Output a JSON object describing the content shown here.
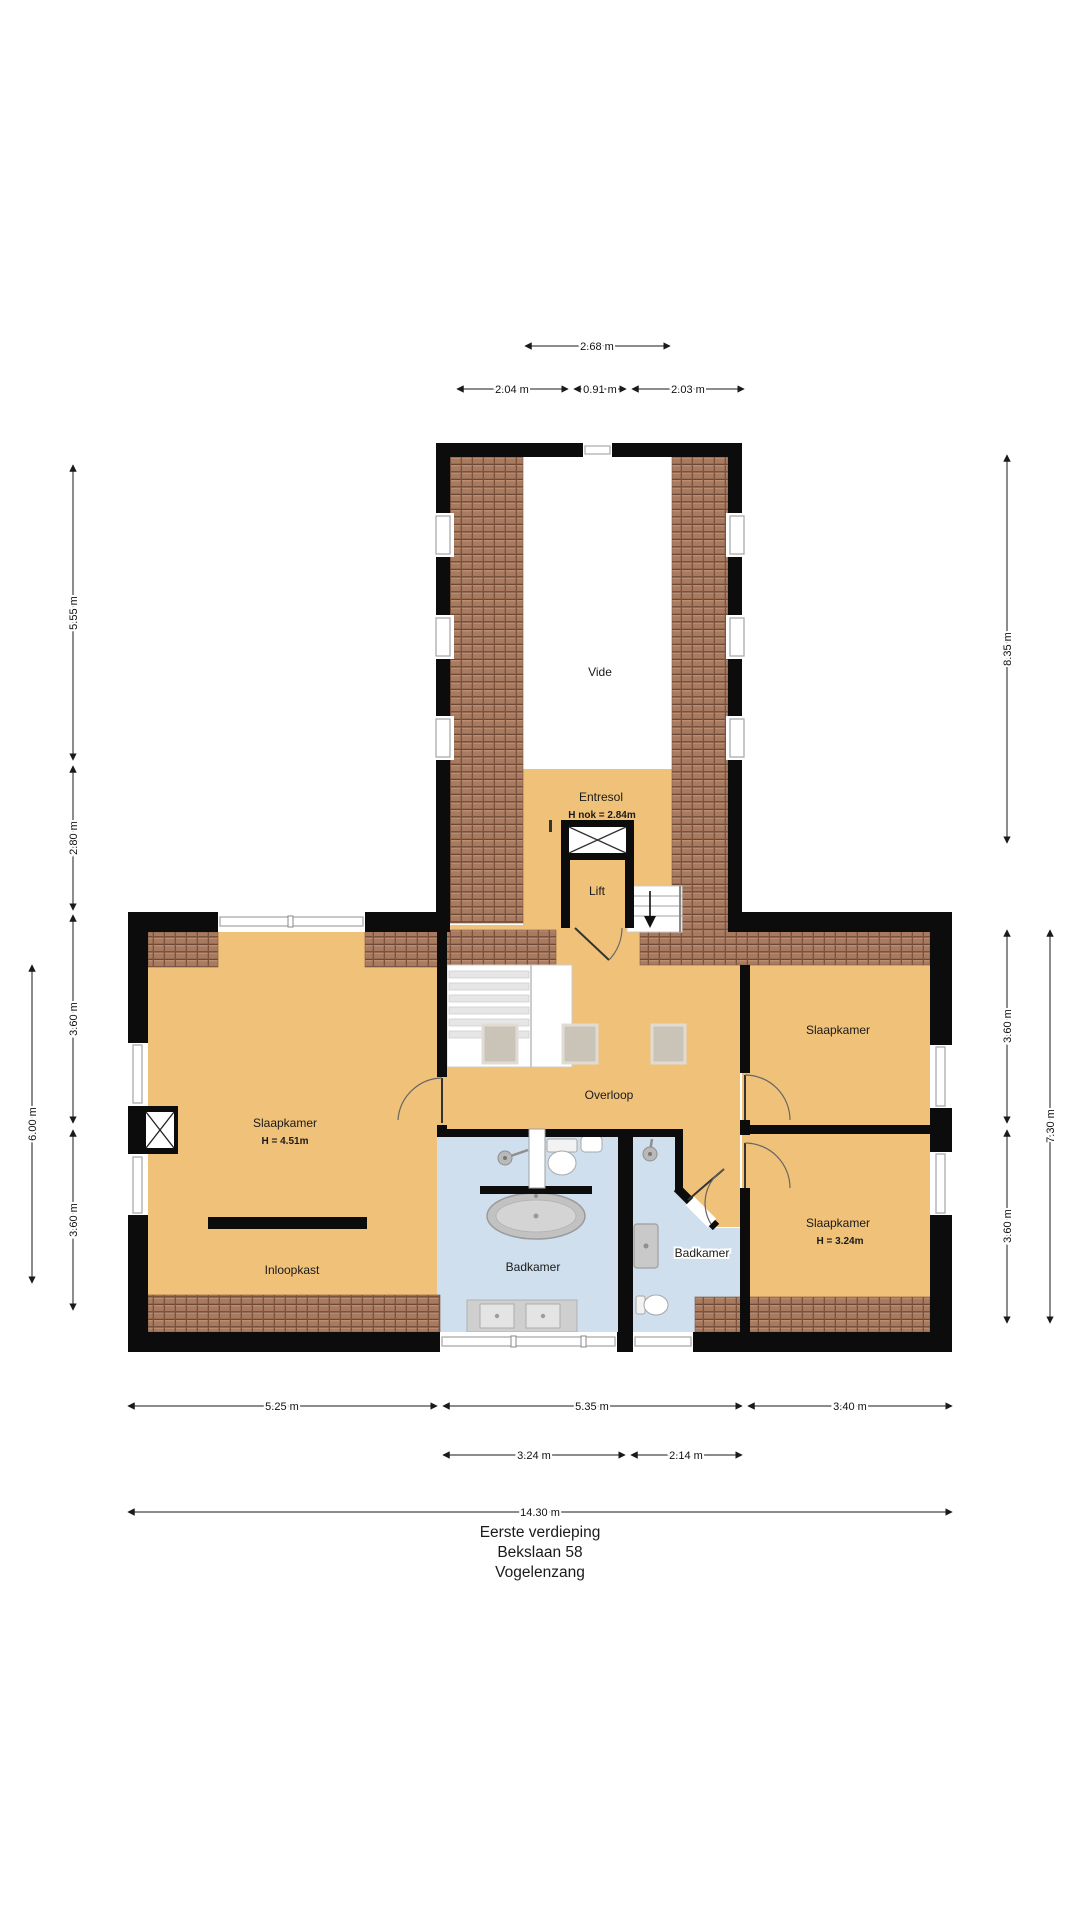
{
  "title": {
    "line1": "Eerste verdieping",
    "line2": "Bekslaan 58",
    "line3": "Vogelenzang"
  },
  "rooms": {
    "vide": {
      "label": "Vide"
    },
    "entresol": {
      "label": "Entresol",
      "sub": "H nok = 2.84m"
    },
    "lift": {
      "label": "Lift"
    },
    "overloop": {
      "label": "Overloop"
    },
    "slaapkamer_left": {
      "label": "Slaapkamer",
      "sub": "H = 4.51m"
    },
    "inloopkast": {
      "label": "Inloopkast"
    },
    "badkamer_main": {
      "label": "Badkamer"
    },
    "badkamer_klein": {
      "label": "Badkamer"
    },
    "slaapkamer_rechts_boven": {
      "label": "Slaapkamer"
    },
    "slaapkamer_rechts_onder": {
      "label": "Slaapkamer",
      "sub": "H = 3.24m"
    }
  },
  "dimensions": {
    "top_268": "2.68 m",
    "top_204": "2.04 m",
    "top_091": "0.91 m",
    "top_203": "2.03 m",
    "left_555": "5.55 m",
    "left_280": "2.80 m",
    "left_360a": "3.60 m",
    "left_600": "6.00 m",
    "left_360b": "3.60 m",
    "right_835": "8.35 m",
    "right_360a": "3.60 m",
    "right_360b": "3.60 m",
    "right_730": "7.30 m",
    "bottom_525": "5.25 m",
    "bottom_535": "5.35 m",
    "bottom_340": "3.40 m",
    "bottom_324": "3.24 m",
    "bottom_214": "2.14 m",
    "bottom_1430": "14.30 m"
  },
  "colors": {
    "floor_orange": "#f0c179",
    "floor_bath": "#cfdfee",
    "roof_tile": "#a87a60",
    "wall": "#0c0c0c",
    "fixture_gray": "#c9c9c9"
  }
}
